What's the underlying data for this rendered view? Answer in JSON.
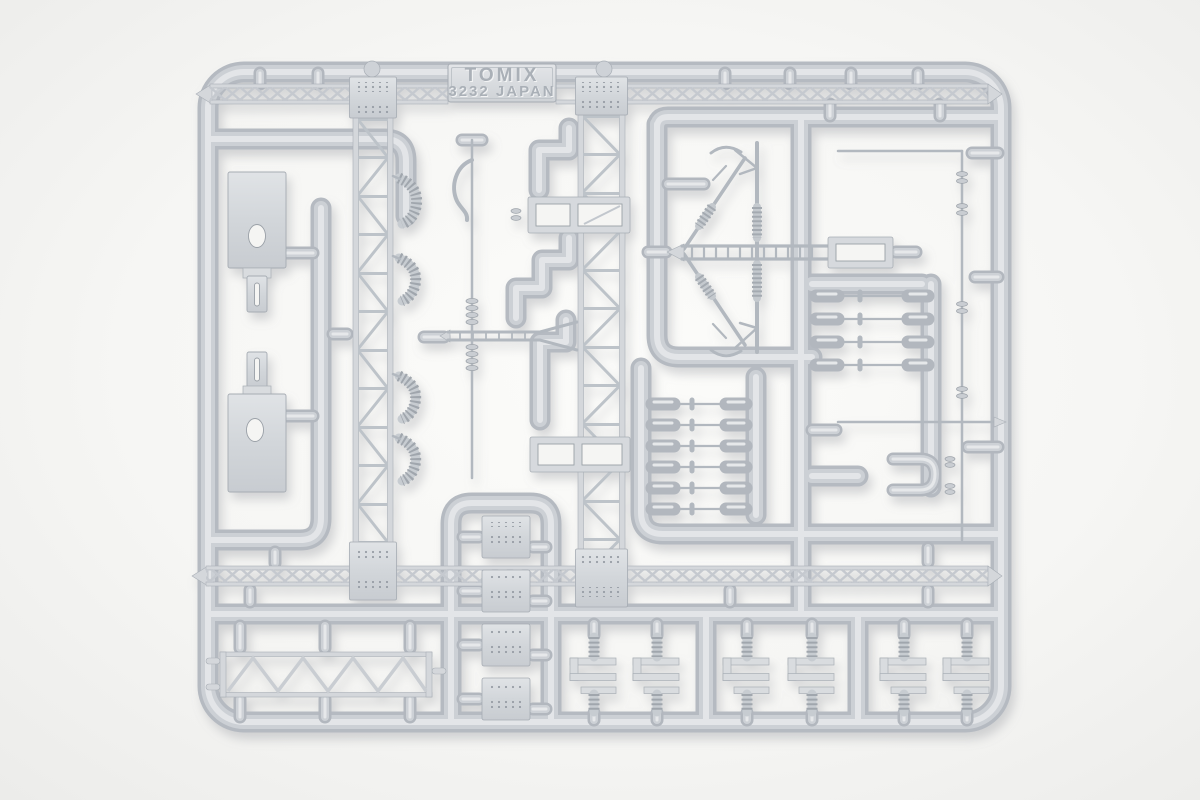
{
  "scene": {
    "description": "Injection-molded light gray plastic model parts sprue photographed on a white background",
    "label": {
      "line1": "TOMIX",
      "line2": "3232 JAPAN"
    },
    "colors": {
      "background": "#f6f6f4",
      "plastic_base": "#c5cacf",
      "plastic_mid": "#ccd0d5",
      "plastic_highlight": "#e3e5e8",
      "plastic_edge": "#a8aeb5",
      "drop_shadow": "#8d9297"
    },
    "parts": [
      "sprue-frame",
      "runner-tubes",
      "maker-label-plate",
      "lattice-girder-top",
      "lattice-girder-bottom",
      "lattice-tower-left",
      "lattice-tower-right",
      "anchor-plate-upper",
      "anchor-plate-lower",
      "rivet-plate-column",
      "rect-frame-part-upper",
      "rect-frame-part-lower",
      "ladder-beam",
      "y-beam",
      "catenary-mast-assembly",
      "insulator-rod-row",
      "insulator-rod-column",
      "thin-wire-parts",
      "truss-beam",
      "hanger-bracket-row",
      "coil-spring-parts"
    ]
  }
}
